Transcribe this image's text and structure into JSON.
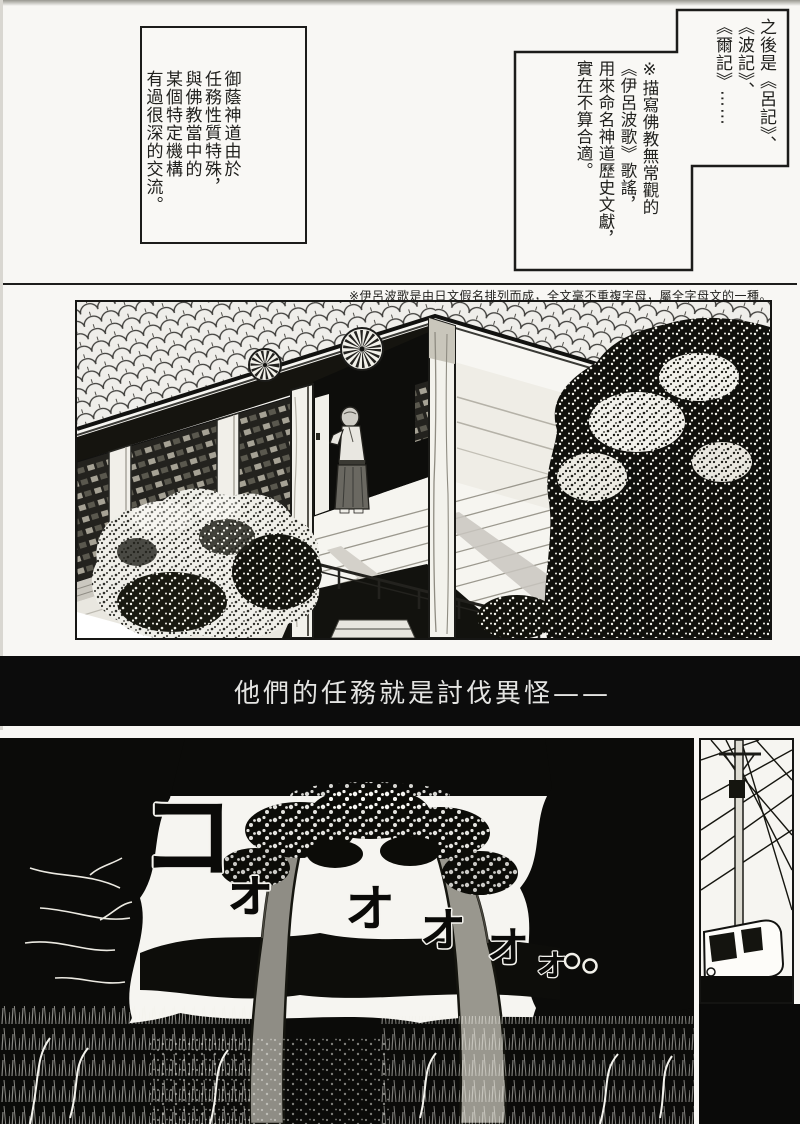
{
  "page": {
    "background": "#f8f7f4",
    "ink": "#161614"
  },
  "narration": {
    "left_box": {
      "text": "御蔭神道由於\n任務性質特殊，\n與佛教當中的\n某個特定機構\n有過很深的交流。"
    },
    "right_box": {
      "upper_text": "之後是《呂記》、\n《波記》、\n《爾記》⋯⋯",
      "lower_text": "※描寫佛教無常觀的\n《伊呂波歌》歌謠，\n用來命名神道歷史文獻，\n實在不算合適。"
    }
  },
  "footnote": {
    "text": "※伊呂波歌是由日文假名排列而成，全文毫不重複字母，屬全字母文的一種。"
  },
  "caption": {
    "text": "他們的任務就是討伐異怪——",
    "background": "#0c0c0c",
    "color": "#e4e4e2"
  },
  "panels": {
    "temple": {
      "name": "temple-veranda-scene"
    },
    "forest": {
      "name": "dark-forest-arch-scene"
    },
    "utility": {
      "name": "utility-pole-van-scene"
    }
  },
  "sfx": {
    "glyphs": [
      {
        "char": "コ"
      },
      {
        "char": "ォ"
      },
      {
        "char": "オ"
      },
      {
        "char": "オ"
      },
      {
        "char": "オ"
      },
      {
        "char": "ォ"
      }
    ]
  }
}
